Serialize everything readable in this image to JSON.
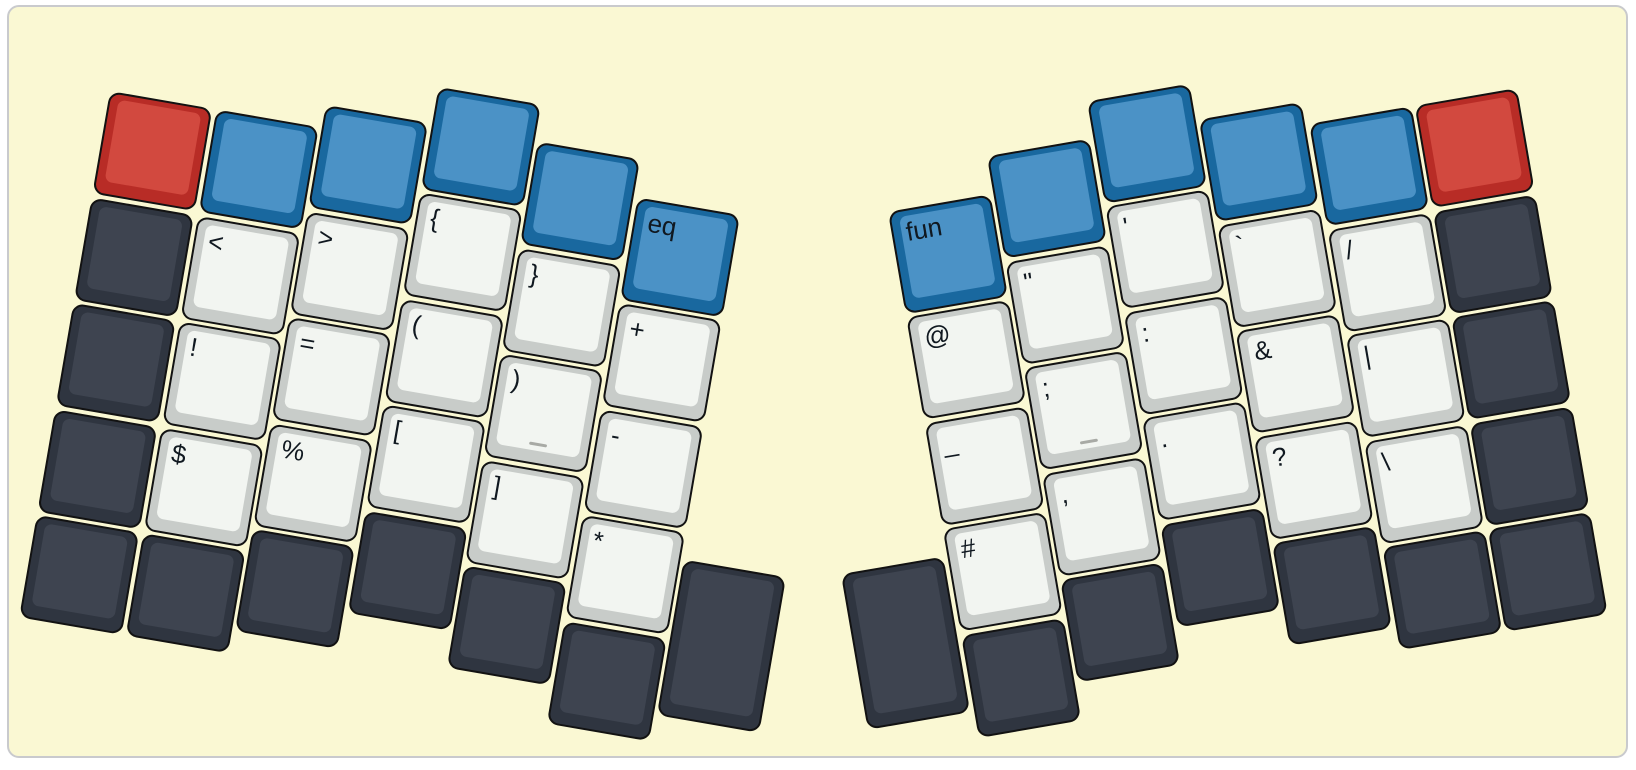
{
  "canvas": {
    "page_background": "#ffffff",
    "background": "#FAF8D3",
    "border_color": "#c9cacd"
  },
  "palette": {
    "red": {
      "side": "#b82c26",
      "top": "#d2493f"
    },
    "blue": {
      "side": "#19689f",
      "top": "#4b92c6"
    },
    "dark": {
      "side": "#2f3540",
      "top": "#3e4450"
    },
    "light": {
      "side": "#c8ccc9",
      "top": "#f2f5f1"
    },
    "legend_color": "#101820",
    "homing_bar_color": "#a8aaa5"
  },
  "layout": {
    "unit_px": 107.5,
    "gap_px": 3.5,
    "halves": {
      "left": {
        "origin": [
          108,
          89
        ],
        "rotation_deg": 9.8,
        "mirrored": false,
        "keys": [
          {
            "x": 0,
            "y": 0,
            "c": "red"
          },
          {
            "x": 0,
            "y": 1,
            "c": "dark"
          },
          {
            "x": 0,
            "y": 2,
            "c": "dark"
          },
          {
            "x": 0,
            "y": 3,
            "c": "dark"
          },
          {
            "x": 0,
            "y": 4,
            "c": "dark"
          },
          {
            "x": 1,
            "y": 0,
            "c": "blue"
          },
          {
            "x": 1,
            "y": 1,
            "c": "light",
            "label": "<"
          },
          {
            "x": 1,
            "y": 2,
            "c": "light",
            "label": "!"
          },
          {
            "x": 1,
            "y": 3,
            "c": "light",
            "label": "$"
          },
          {
            "x": 1,
            "y": 4,
            "c": "dark"
          },
          {
            "x": 2,
            "y": -0.21,
            "c": "blue"
          },
          {
            "x": 2,
            "y": 0.79,
            "c": "light",
            "label": ">"
          },
          {
            "x": 2,
            "y": 1.79,
            "c": "light",
            "label": "="
          },
          {
            "x": 2,
            "y": 2.79,
            "c": "light",
            "label": "%"
          },
          {
            "x": 2,
            "y": 3.79,
            "c": "dark"
          },
          {
            "x": 3,
            "y": -0.56,
            "c": "blue"
          },
          {
            "x": 3,
            "y": 0.44,
            "c": "light",
            "label": "{"
          },
          {
            "x": 3,
            "y": 1.44,
            "c": "light",
            "label": "("
          },
          {
            "x": 3,
            "y": 2.44,
            "c": "light",
            "label": "["
          },
          {
            "x": 3,
            "y": 3.44,
            "c": "dark"
          },
          {
            "x": 4,
            "y": -0.21,
            "c": "blue"
          },
          {
            "x": 4,
            "y": 0.79,
            "c": "light",
            "label": "}"
          },
          {
            "x": 4,
            "y": 1.79,
            "c": "light",
            "label": ")",
            "homing": true
          },
          {
            "x": 4,
            "y": 2.79,
            "c": "light",
            "label": "]"
          },
          {
            "x": 4,
            "y": 3.79,
            "c": "dark"
          },
          {
            "x": 5,
            "y": 0.135,
            "c": "blue",
            "label": "eq"
          },
          {
            "x": 5,
            "y": 1.135,
            "c": "light",
            "label": "+"
          },
          {
            "x": 5,
            "y": 2.135,
            "c": "light",
            "label": "-"
          },
          {
            "x": 5,
            "y": 3.135,
            "c": "light",
            "label": "*"
          },
          {
            "x": 5,
            "y": 4.135,
            "c": "dark"
          },
          {
            "x": 6,
            "y": 3.39,
            "w": 1,
            "h": 1.5,
            "c": "dark"
          }
        ]
      },
      "right": {
        "origin": [
          1515,
          86
        ],
        "rotation_deg": -9.8,
        "mirrored": true,
        "keys": [
          {
            "x": 0,
            "y": 0,
            "c": "red"
          },
          {
            "x": 0,
            "y": 1,
            "c": "dark"
          },
          {
            "x": 0,
            "y": 2,
            "c": "dark"
          },
          {
            "x": 0,
            "y": 3,
            "c": "dark"
          },
          {
            "x": 0,
            "y": 4,
            "c": "dark"
          },
          {
            "x": 1,
            "y": 0,
            "c": "blue"
          },
          {
            "x": 1,
            "y": 1,
            "c": "light",
            "label": "/"
          },
          {
            "x": 1,
            "y": 2,
            "c": "light",
            "label": "|"
          },
          {
            "x": 1,
            "y": 3,
            "c": "light",
            "label": "\\"
          },
          {
            "x": 1,
            "y": 4,
            "c": "dark"
          },
          {
            "x": 2,
            "y": -0.21,
            "c": "blue"
          },
          {
            "x": 2,
            "y": 0.79,
            "c": "light",
            "label": "`"
          },
          {
            "x": 2,
            "y": 1.79,
            "c": "light",
            "label": "&"
          },
          {
            "x": 2,
            "y": 2.79,
            "c": "light",
            "label": "?"
          },
          {
            "x": 2,
            "y": 3.79,
            "c": "dark"
          },
          {
            "x": 3,
            "y": -0.56,
            "c": "blue"
          },
          {
            "x": 3,
            "y": 0.44,
            "c": "light",
            "label": "'"
          },
          {
            "x": 3,
            "y": 1.44,
            "c": "light",
            "label": ":"
          },
          {
            "x": 3,
            "y": 2.44,
            "c": "light",
            "label": "."
          },
          {
            "x": 3,
            "y": 3.44,
            "c": "dark"
          },
          {
            "x": 4,
            "y": -0.21,
            "c": "blue"
          },
          {
            "x": 4,
            "y": 0.79,
            "c": "light",
            "label": "\""
          },
          {
            "x": 4,
            "y": 1.79,
            "c": "light",
            "label": ";",
            "homing": true
          },
          {
            "x": 4,
            "y": 2.79,
            "c": "light",
            "label": ","
          },
          {
            "x": 4,
            "y": 3.79,
            "c": "dark"
          },
          {
            "x": 5,
            "y": 0.135,
            "c": "blue",
            "label": "fun"
          },
          {
            "x": 5,
            "y": 1.135,
            "c": "light",
            "label": "@"
          },
          {
            "x": 5,
            "y": 2.135,
            "c": "light",
            "label": "_"
          },
          {
            "x": 5,
            "y": 3.135,
            "c": "light",
            "label": "#"
          },
          {
            "x": 5,
            "y": 4.135,
            "c": "dark"
          },
          {
            "x": 6,
            "y": 3.39,
            "w": 1,
            "h": 1.5,
            "c": "dark"
          }
        ]
      }
    }
  }
}
